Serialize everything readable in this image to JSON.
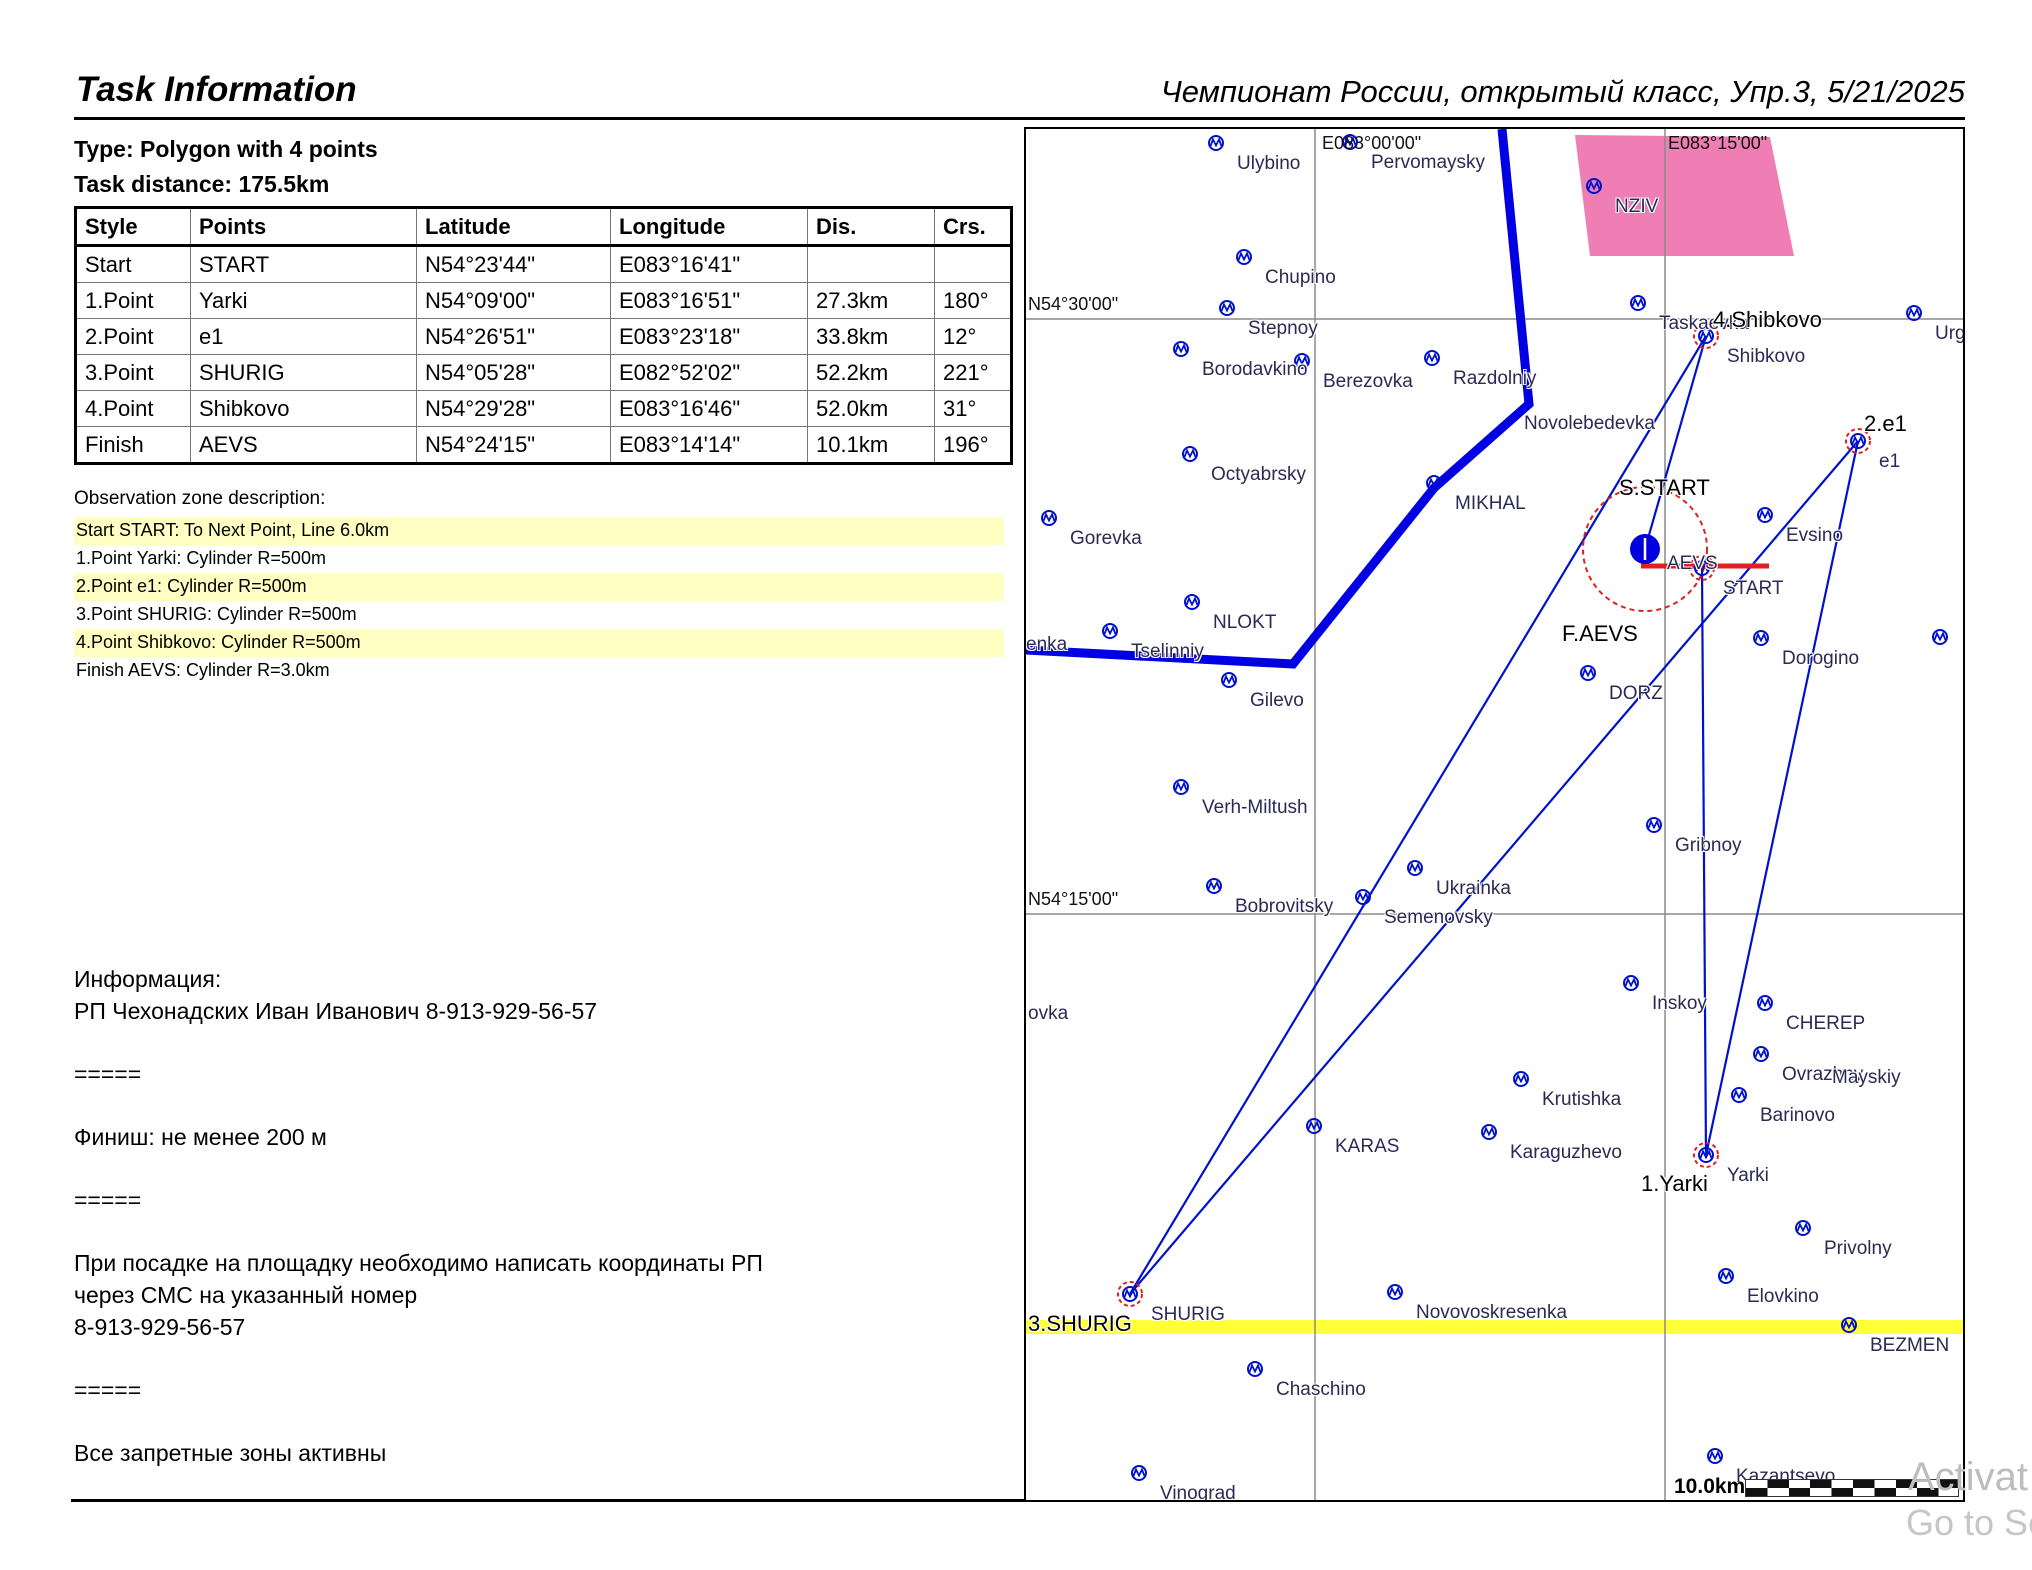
{
  "header": {
    "title_left": "Task Information",
    "title_right": "Чемпионат России, открытый класс, Упр.3, 5/21/2025"
  },
  "task": {
    "type_line": "Type: Polygon with 4 points",
    "distance_line": "Task distance: 175.5km"
  },
  "table": {
    "columns": [
      "Style",
      "Points",
      "Latitude",
      "Longitude",
      "Dis.",
      "Crs."
    ],
    "rows": [
      [
        "Start",
        "START",
        "N54°23'44\"",
        "E083°16'41\"",
        "",
        ""
      ],
      [
        "1.Point",
        "Yarki",
        "N54°09'00\"",
        "E083°16'51\"",
        "27.3km",
        "180°"
      ],
      [
        "2.Point",
        "e1",
        "N54°26'51\"",
        "E083°23'18\"",
        "33.8km",
        "12°"
      ],
      [
        "3.Point",
        "SHURIG",
        "N54°05'28\"",
        "E082°52'02\"",
        "52.2km",
        "221°"
      ],
      [
        "4.Point",
        "Shibkovo",
        "N54°29'28\"",
        "E083°16'46\"",
        "52.0km",
        "31°"
      ],
      [
        "Finish",
        "AEVS",
        "N54°24'15\"",
        "E083°14'14\"",
        "10.1km",
        "196°"
      ]
    ]
  },
  "observation": {
    "title": "Observation zone description:",
    "lines": [
      {
        "text": "Start START: To Next Point, Line 6.0km",
        "highlighted": true
      },
      {
        "text": "1.Point Yarki: Cylinder R=500m",
        "highlighted": false
      },
      {
        "text": "2.Point e1: Cylinder R=500m",
        "highlighted": true
      },
      {
        "text": "3.Point SHURIG: Cylinder R=500m",
        "highlighted": false
      },
      {
        "text": "4.Point Shibkovo: Cylinder R=500m",
        "highlighted": true
      },
      {
        "text": "Finish AEVS: Cylinder R=3.0km",
        "highlighted": false
      }
    ]
  },
  "info": {
    "paragraphs": [
      [
        "Информация:",
        "РП Чехонадских Иван Иванович 8-913-929-56-57"
      ],
      [
        "====="
      ],
      [
        "Финиш: не менее 200 м"
      ],
      [
        "====="
      ],
      [
        "При посадке на площадку необходимо написать координаты РП",
        "через СМС на указанный номер",
        "8-913-929-56-57"
      ],
      [
        "====="
      ],
      [
        "Все запретные зоны активны"
      ]
    ]
  },
  "colors": {
    "blue": "#0011cc",
    "thickblue": "#0000e2",
    "red": "#e02020",
    "grid": "#8a8a8a",
    "pink": "#ee7eb4",
    "band": "#ffff3a",
    "hl": "#ffffc4",
    "wm": "#bdbdbd",
    "wplabel": "#2a2a55"
  },
  "map": {
    "scale_label": "10.0km",
    "grid_labels": [
      {
        "text": "N54°30'00\"",
        "x": 2,
        "y": 165
      },
      {
        "text": "N54°15'00\"",
        "x": 2,
        "y": 760
      },
      {
        "text": "E083°00'00\"",
        "x": 296,
        "y": 4
      },
      {
        "text": "E083°15'00\"",
        "x": 642,
        "y": 4
      }
    ],
    "waypoints": [
      {
        "name": "Ulybino",
        "x": 190,
        "y": 14
      },
      {
        "name": "Pervomaysky",
        "x": 324,
        "y": 13
      },
      {
        "name": "NZIV",
        "x": 568,
        "y": 57
      },
      {
        "name": "Chupino",
        "x": 218,
        "y": 128
      },
      {
        "name": "Stepnoy",
        "x": 201,
        "y": 179
      },
      {
        "name": "Taskaevka",
        "x": 612,
        "y": 174
      },
      {
        "name": "Shibkovo",
        "x": 680,
        "y": 207
      },
      {
        "name": "Urgun",
        "x": 888,
        "y": 184
      },
      {
        "name": "Borodavkino",
        "x": 155,
        "y": 220
      },
      {
        "name": "Berezovka",
        "x": 276,
        "y": 232
      },
      {
        "name": "Razdolniy",
        "x": 406,
        "y": 229
      },
      {
        "name": "Octyabrsky",
        "x": 164,
        "y": 325
      },
      {
        "name": "MIKHAL",
        "x": 408,
        "y": 354
      },
      {
        "name": "e1",
        "x": 832,
        "y": 312
      },
      {
        "name": "Evsino",
        "x": 739,
        "y": 386
      },
      {
        "name": "START",
        "x": 676,
        "y": 439
      },
      {
        "name": "Gorevka",
        "x": 23,
        "y": 389
      },
      {
        "name": "NLOKT",
        "x": 166,
        "y": 473
      },
      {
        "name": "Tselinniy",
        "x": 84,
        "y": 502
      },
      {
        "name": "Gilevo",
        "x": 203,
        "y": 551
      },
      {
        "name": "DORZ",
        "x": 562,
        "y": 544
      },
      {
        "name": "Dorogino",
        "x": 735,
        "y": 509
      },
      {
        "name": "",
        "x": 914,
        "y": 508
      },
      {
        "name": "Verh-Miltush",
        "x": 155,
        "y": 658
      },
      {
        "name": "Gribnoy",
        "x": 628,
        "y": 696
      },
      {
        "name": "Ukrainka",
        "x": 389,
        "y": 739
      },
      {
        "name": "Bobrovitsky",
        "x": 188,
        "y": 757
      },
      {
        "name": "Semenovsky",
        "x": 337,
        "y": 768
      },
      {
        "name": "Inskoy",
        "x": 605,
        "y": 854
      },
      {
        "name": "CHEREP",
        "x": 739,
        "y": 874
      },
      {
        "name": "Ovrazhny",
        "x": 735,
        "y": 925
      },
      {
        "name": "Krutishka",
        "x": 495,
        "y": 950
      },
      {
        "name": "Barinovo",
        "x": 713,
        "y": 966
      },
      {
        "name": "KARAS",
        "x": 288,
        "y": 997
      },
      {
        "name": "Karaguzhevo",
        "x": 463,
        "y": 1003
      },
      {
        "name": "Yarki",
        "x": 680,
        "y": 1026
      },
      {
        "name": "Privolny",
        "x": 777,
        "y": 1099
      },
      {
        "name": "Elovkino",
        "x": 700,
        "y": 1147
      },
      {
        "name": "Novovoskresenka",
        "x": 369,
        "y": 1163
      },
      {
        "name": "SHURIG",
        "x": 104,
        "y": 1165
      },
      {
        "name": "BEZMEN",
        "x": 823,
        "y": 1196
      },
      {
        "name": "Chaschino",
        "x": 229,
        "y": 1240
      },
      {
        "name": "Vinograd",
        "x": 113,
        "y": 1344
      },
      {
        "name": "Kazantsevo",
        "x": 689,
        "y": 1327
      }
    ],
    "labels": [
      {
        "text": "S.START",
        "x": 593,
        "y": 346,
        "cls": "task-label"
      },
      {
        "text": "4.Shibkovo",
        "x": 687,
        "y": 178,
        "cls": "task-label"
      },
      {
        "text": "2.e1",
        "x": 838,
        "y": 282,
        "cls": "task-label"
      },
      {
        "text": "1.Yarki",
        "x": 615,
        "y": 1042,
        "cls": "task-label"
      },
      {
        "text": "3.SHURIG",
        "x": 2,
        "y": 1182,
        "cls": "task-label"
      },
      {
        "text": "F.AEVS",
        "x": 536,
        "y": 492,
        "cls": "task-label"
      },
      {
        "text": "AEVS",
        "x": 641,
        "y": 424,
        "cls": "wp-label"
      },
      {
        "text": "Novolebedevka",
        "x": 498,
        "y": 284,
        "cls": "wp-label"
      },
      {
        "text": "Mayskiy",
        "x": 806,
        "y": 938,
        "cls": "wp-label"
      },
      {
        "text": "enka",
        "x": 0,
        "y": 505,
        "cls": "wp-label"
      },
      {
        "text": "ovka",
        "x": 2,
        "y": 874,
        "cls": "wp-label"
      }
    ],
    "svg": {
      "width": 939,
      "height": 1373,
      "zone_points": "549,6 744,8 768,127 564,127",
      "gridlines_h": [
        190,
        785
      ],
      "gridlines_v": [
        289,
        639
      ],
      "airspace_line": "476,0 503,275 408,359 267,535 0,521",
      "task_segments": [
        [
          676,
          439,
          680,
          1026
        ],
        [
          680,
          1026,
          832,
          312
        ],
        [
          832,
          312,
          104,
          1165
        ],
        [
          104,
          1165,
          680,
          207
        ],
        [
          680,
          207,
          619,
          420
        ]
      ],
      "start_line": [
        615,
        437,
        743,
        437
      ],
      "finish_circle": {
        "cx": 619,
        "cy": 420,
        "r": 62
      },
      "aevs_dot": {
        "cx": 619,
        "cy": 420,
        "r": 15
      },
      "rings": [
        [
          680,
          207
        ],
        [
          832,
          312
        ],
        [
          680,
          1026
        ],
        [
          104,
          1165
        ],
        [
          676,
          439
        ]
      ]
    }
  },
  "watermark": {
    "line1": "Activat",
    "line2": "Go to Set"
  }
}
